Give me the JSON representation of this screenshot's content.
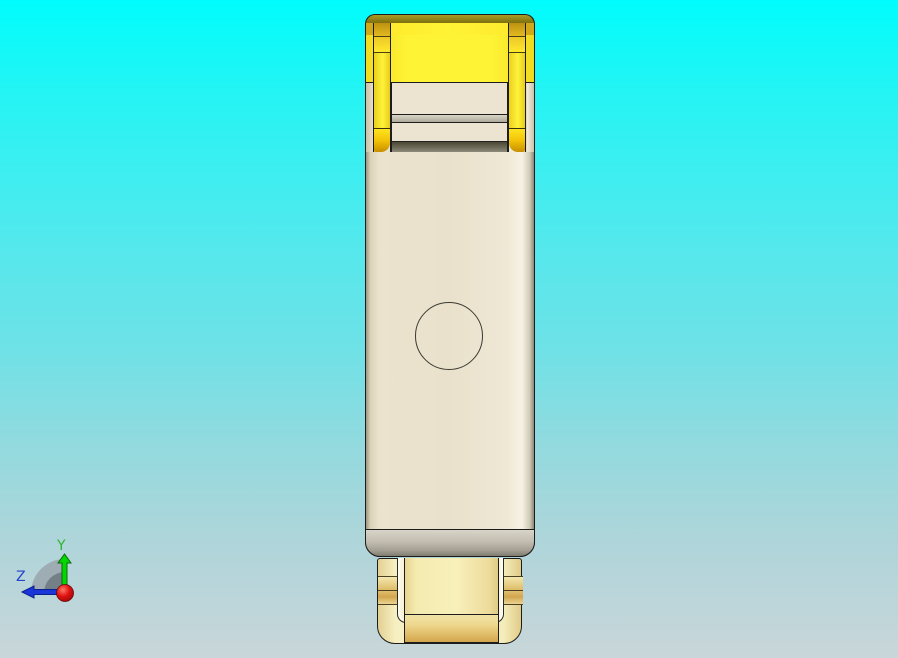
{
  "viewport": {
    "type": "cad-3d-view",
    "content": "single shaded part, front view: rectangular body with yellow cap clip on top and yellow connector shield at bottom, circular detail on body face"
  },
  "triad": {
    "labels": {
      "y": "Y",
      "z": "Z"
    },
    "axes": [
      {
        "name": "y-axis",
        "direction": "up",
        "color": "#00d800"
      },
      {
        "name": "z-axis",
        "direction": "left",
        "color": "#1a36d8"
      }
    ],
    "origin": {
      "name": "origin-sphere",
      "color": "#e01212"
    }
  },
  "palette": {
    "bg_top": "#00fdfd",
    "bg_mid": "#6ce2e7",
    "bg_bottom": "#c9d6d9",
    "outline": "#1c1c1c",
    "body_face": "#ece4d0",
    "band_gray_light": "#d9d4c8",
    "band_gray_dark": "#807b6f",
    "cap_olive_dark": "#7d6f0e",
    "cap_yellow": "#fff335",
    "cap_yellow_deep": "#f0da20",
    "cap_gold_light": "#ffe41f",
    "cap_gold_dark": "#c78f00",
    "groove_light": "#d8d4c6",
    "groove_dark": "#aeaa9b",
    "shadow_band_dark": "#4a4734",
    "shadow_band_light": "#8e8a7a",
    "conn_pale": "#faf4cc",
    "conn_cream": "#f8f3da",
    "conn_tongue": "#f8f0ba",
    "conn_gold_mid": "#d2a74e",
    "conn_gold_deep": "#d2a54c",
    "axis_green": "#00d800",
    "axis_green_dark": "#0b6b0b",
    "axis_blue": "#1a36d8",
    "axis_blue_dark": "#0b1f8e",
    "origin_red": "#d21010",
    "origin_red_dark": "#8d0606",
    "fan_outer": "#9aa4ab",
    "fan_inner": "#6f7a83",
    "label_green": "#2db52d",
    "label_blue": "#2543cb"
  }
}
